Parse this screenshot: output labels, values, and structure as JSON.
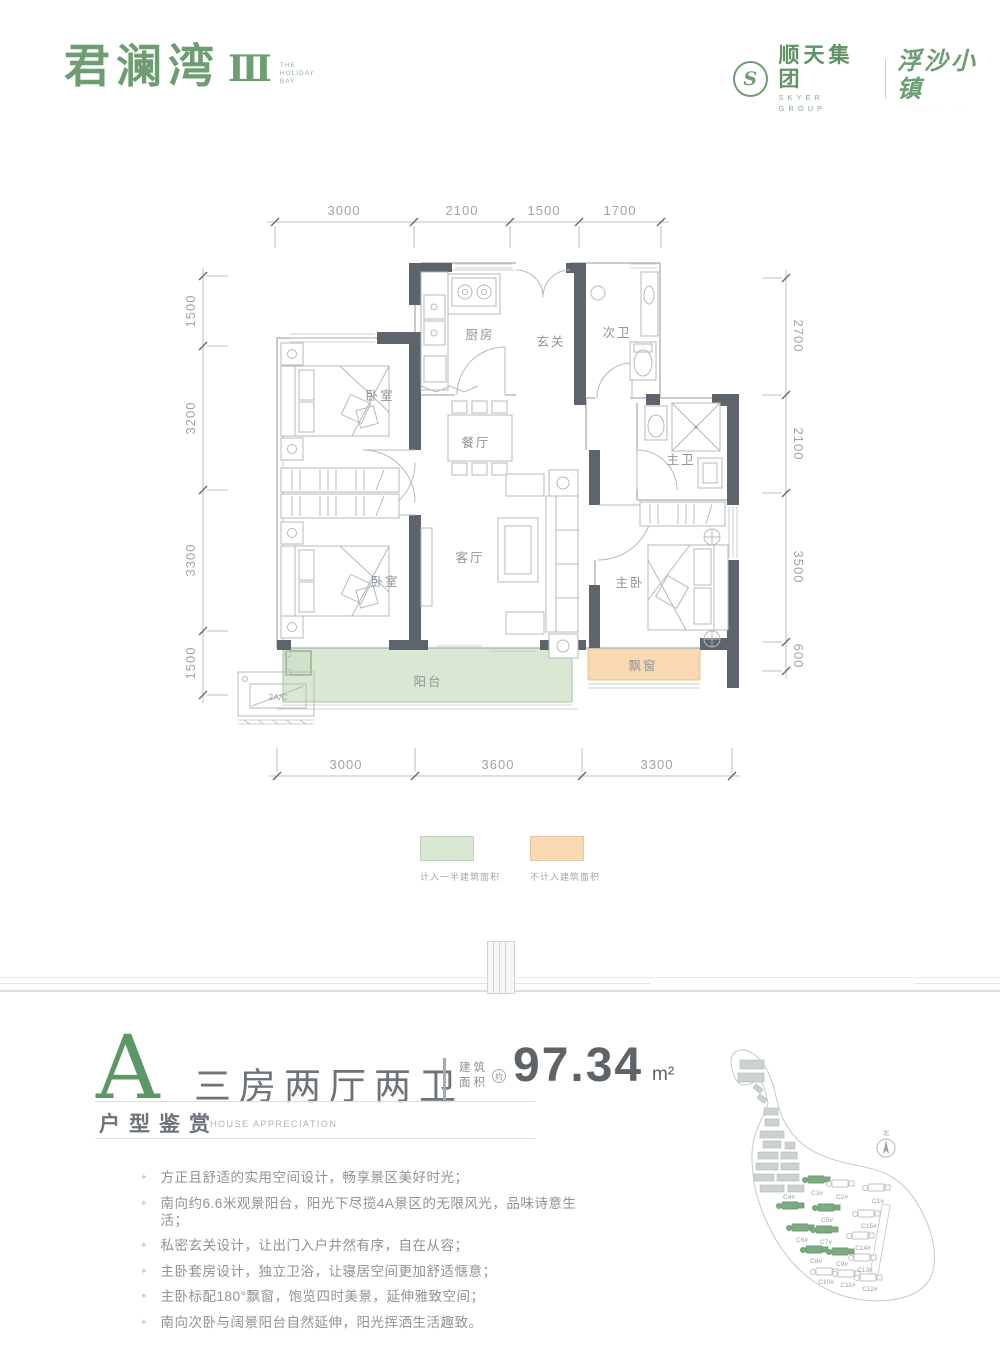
{
  "header": {
    "brand": "君澜湾",
    "brand_num": "Ⅲ",
    "brand_sub": [
      "THE",
      "HOLIDAY",
      "BAY"
    ],
    "logo_letter": "S",
    "company": "顺天集团",
    "company_en": "SKYER GROUP",
    "town": "浮沙小镇",
    "town_dots": "· · · · · · · ·"
  },
  "plan": {
    "dims_top": [
      "3000",
      "2100",
      "1500",
      "1700"
    ],
    "dims_left": [
      "1500",
      "3200",
      "3300",
      "1500"
    ],
    "dims_right": [
      "2700",
      "2100",
      "3500",
      "600"
    ],
    "dims_bottom": [
      "3000",
      "3600",
      "3300"
    ],
    "rooms": {
      "bedroom1": "卧室",
      "bedroom2": "卧室",
      "kitchen": "厨房",
      "entry": "玄关",
      "bath2": "次卫",
      "dining": "餐厅",
      "bath_master": "主卫",
      "living": "客厅",
      "master": "主卧",
      "balcony": "阳台",
      "bay_window": "飘窗",
      "ac_unit": "2A/C"
    },
    "legend": [
      {
        "color": "#d9e8d2",
        "label": "计入一半建筑面积"
      },
      {
        "color": "#f8d9b1",
        "label": "不计入建筑面积"
      }
    ]
  },
  "summary": {
    "type_letter": "A",
    "layout": "三房两厅两卫",
    "area_label_1": "建筑",
    "area_label_2": "面积",
    "area_approx": "约",
    "area_value": "97.34",
    "area_unit": "m²",
    "section_title": "户型鉴赏",
    "section_title_en": "HOUSE APPRECIATION",
    "features": [
      "方正且舒适的实用空间设计，畅享景区美好时光；",
      "南向约6.6米观景阳台，阳光下尽揽4A景区的无限风光，品味诗意生活；",
      "私密玄关设计，让出门入户井然有序，自在从容；",
      "主卧套房设计，独立卫浴，让寝居空间更加舒适惬意；",
      "主卧标配180°飘窗，饱览四时美景，延伸雅致空间；",
      "南向次卧与阔景阳台自然延伸，阳光挥洒生活趣致。"
    ]
  },
  "sitemap": {
    "compass": "北",
    "buildings": [
      {
        "label": "C3#",
        "highlighted": true
      },
      {
        "label": "C2#",
        "highlighted": false
      },
      {
        "label": "C1#",
        "highlighted": false
      },
      {
        "label": "C4#",
        "highlighted": true
      },
      {
        "label": "C5#",
        "highlighted": true
      },
      {
        "label": "C15#",
        "highlighted": false
      },
      {
        "label": "C6#",
        "highlighted": true
      },
      {
        "label": "C7#",
        "highlighted": true
      },
      {
        "label": "C14#",
        "highlighted": false
      },
      {
        "label": "C8#",
        "highlighted": true
      },
      {
        "label": "C9#",
        "highlighted": true
      },
      {
        "label": "C13#",
        "highlighted": false
      },
      {
        "label": "C10#",
        "highlighted": false
      },
      {
        "label": "C11#",
        "highlighted": false
      },
      {
        "label": "C12#",
        "highlighted": false
      }
    ]
  }
}
